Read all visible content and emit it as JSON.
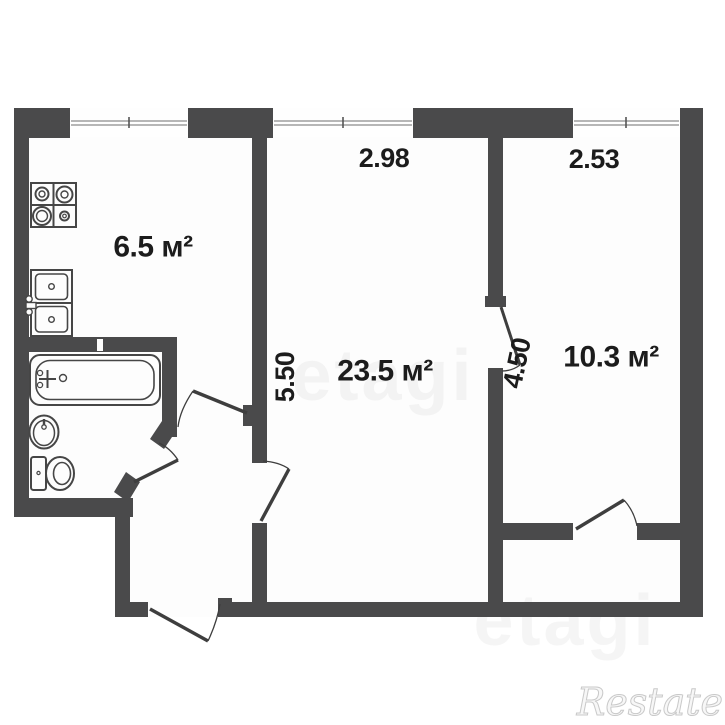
{
  "floor_plan": {
    "rooms": [
      {
        "id": "kitchen",
        "area_label": "6.5 м²"
      },
      {
        "id": "living-room",
        "area_label": "23.5 м²"
      },
      {
        "id": "bedroom",
        "area_label": "10.3 м²"
      }
    ],
    "dimensions": {
      "living_room_width": "2.98",
      "bedroom_width": "2.53",
      "living_room_depth": "5.50",
      "bedroom_depth": "4.50"
    },
    "fixtures": [
      "stove-icon",
      "kitchen-sink-icon",
      "bathtub-icon",
      "washbasin-icon",
      "toilet-icon"
    ],
    "colors": {
      "wall": "#4a4a4b",
      "door_line": "#3e3e3e",
      "fixture_line": "#464646",
      "window_line": "#8a8a8a",
      "label_text": "#1c1c1c",
      "watermark_light": "#ebebeb",
      "watermark_corner": "#c9c9c9"
    }
  },
  "watermarks": {
    "center_brand": "etagi",
    "corner_brand": "Restate"
  }
}
